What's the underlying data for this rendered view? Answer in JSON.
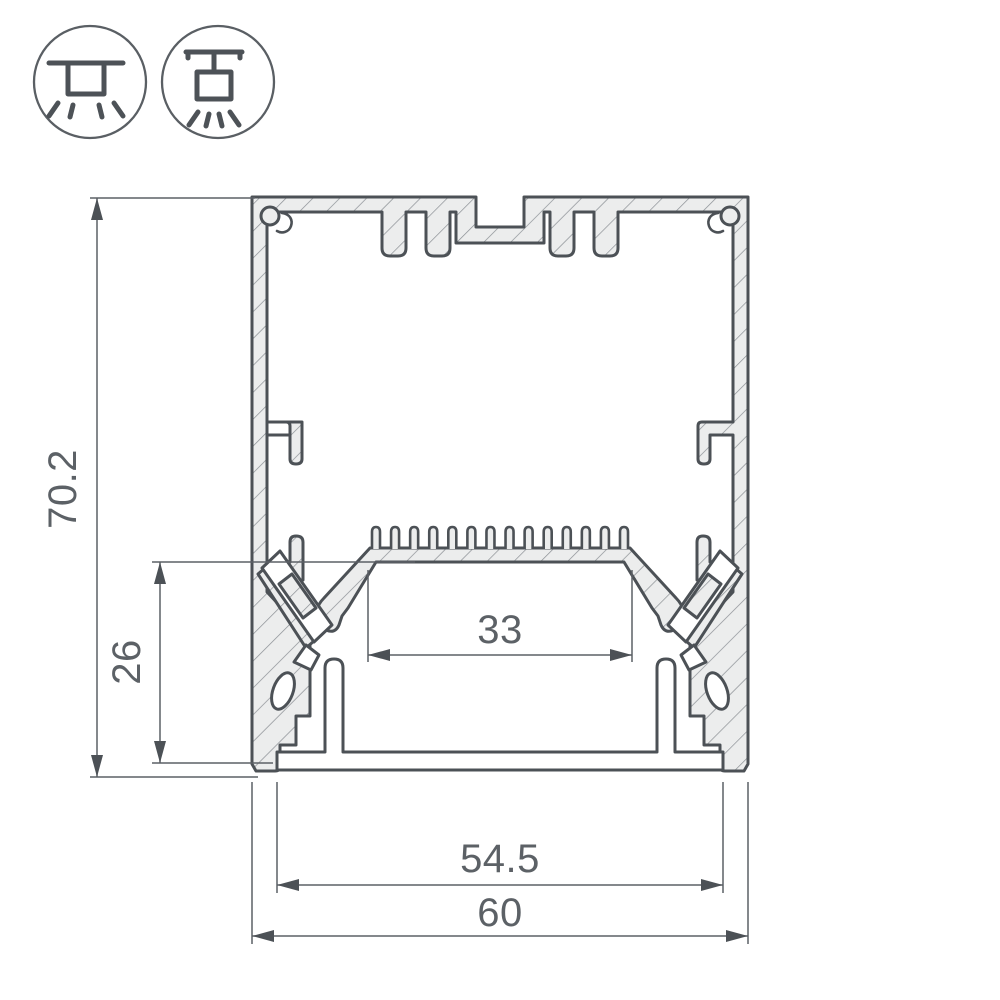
{
  "drawing": {
    "title_semantic": "LED profile cross-section technical drawing",
    "dimensions": {
      "overall_height": "70.2",
      "inner_height": "26",
      "led_shelf_width": "33",
      "diffuser_width": "54.5",
      "overall_width": "60"
    },
    "mount_icons": [
      {
        "name": "surface-mount"
      },
      {
        "name": "pendant-mount"
      }
    ],
    "colors": {
      "outline": "#4C5156",
      "aluminum_fill": "#ECEDED",
      "hatch_line": "#8A8F94",
      "dimension": "#5C6166",
      "background": "#FFFFFF"
    }
  }
}
